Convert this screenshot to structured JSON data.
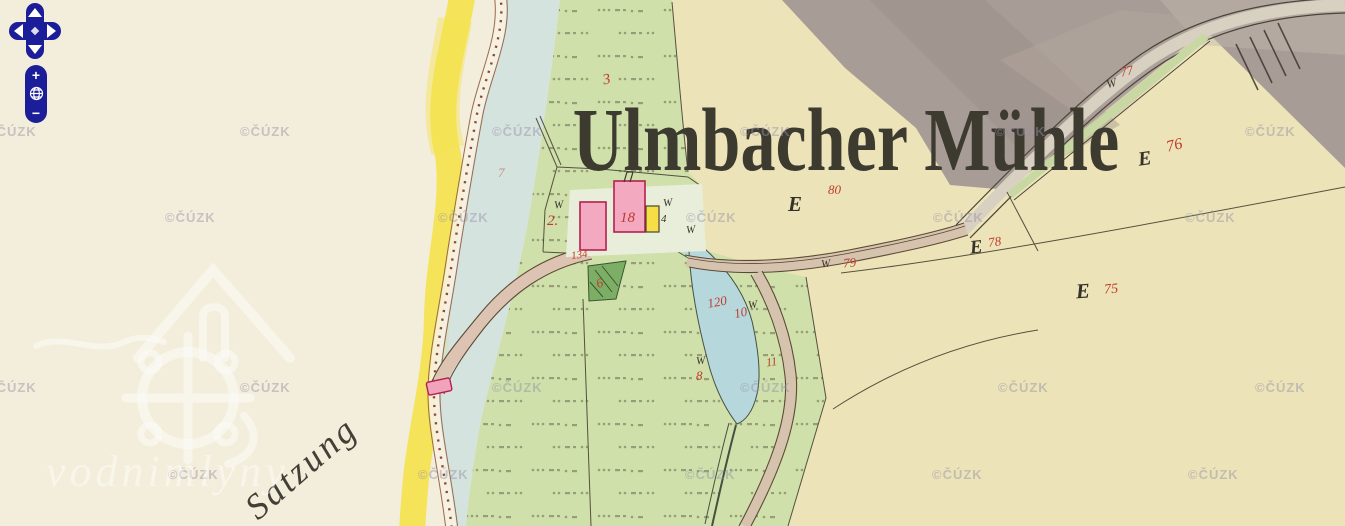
{
  "viewer": {
    "watermark_text": "©ČÚZK",
    "brand_watermark_text": "vodnimlyny",
    "controls": {
      "zoom_in_label": "+",
      "zoom_out_label": "−"
    }
  },
  "map": {
    "title": "Ulmbacher Mühle",
    "handwritten_label": "Satzung",
    "letter_e": "E",
    "letter_w": "W",
    "house_number_black": "4",
    "parcel_numbers": {
      "n2": "2.",
      "n3": "3",
      "n6": "6",
      "n7": "7",
      "n8": "8",
      "n10": "10",
      "n11": "11",
      "n18": "18",
      "n75": "75",
      "n76": "76",
      "n77": "77",
      "n78": "78",
      "n79": "79",
      "n80": "80",
      "n120": "120",
      "n134": "134"
    },
    "colors": {
      "paper_cream": "#f3eddb",
      "field_yellow": "#ece4b8",
      "meadow_green": "#cfe0aa",
      "hill_gray": "#a89d96",
      "water_blue": "#b6d8dc",
      "road_tan": "#d6c3ae",
      "building_pink": "#f3a9c0",
      "building_yellow": "#f6df45",
      "parcel_red": "#c03b2d",
      "control_navy": "#1c1d99",
      "highlight_yellow": "#f5e24f"
    }
  }
}
